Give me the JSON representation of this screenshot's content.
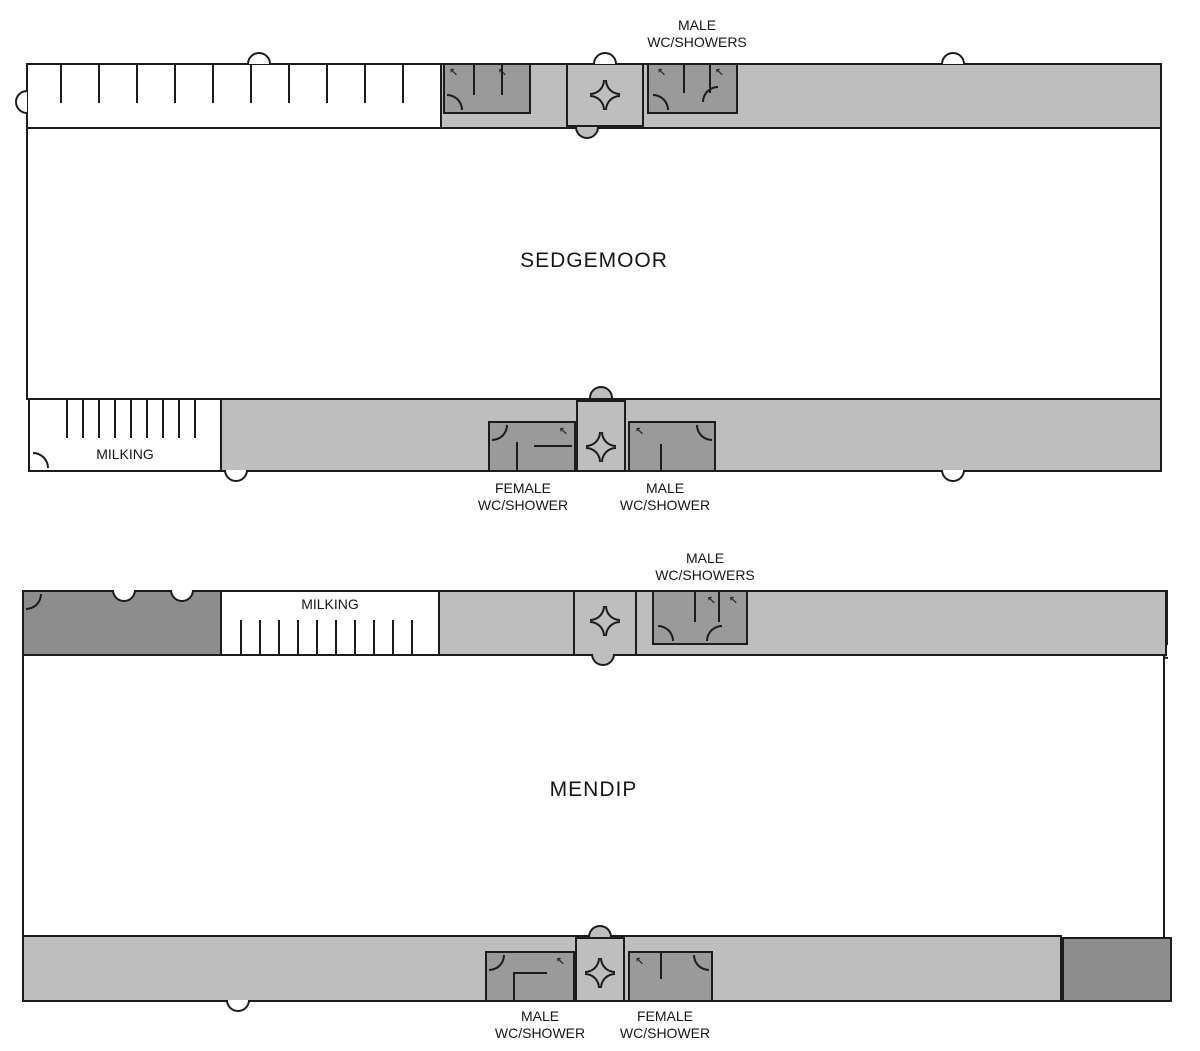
{
  "colors": {
    "light_gray": "#bebebe",
    "wc_gray": "#9a9a9a",
    "block_gray": "#8d8d8d",
    "wall": "#1c1c1c",
    "floor_white": "#ffffff"
  },
  "sedgemoor": {
    "name": "SEDGEMOOR",
    "milking_label": "MILKING",
    "top_outside_label": "MALE\nWC/SHOWERS",
    "bottom_outside_labels": {
      "female": "FEMALE\nWC/SHOWER",
      "male": "MALE\nWC/SHOWER"
    },
    "beds_top": [
      "BED\n45",
      "BED\n46",
      "BED\n47",
      "BED\n48",
      "BED\n49"
    ],
    "rooms_top_right": [
      "50",
      "51",
      "52",
      "53",
      "54"
    ],
    "rooms_bottom_left": [
      "BED\n44",
      "BED\n43",
      "BED\n42",
      "BED\n41",
      "ELEC"
    ],
    "beds_bottom_mid": [
      "BED\n40",
      "BED\n39",
      "BED\n38",
      "BED\n37",
      "BED\n36",
      "BED\n35"
    ],
    "beds_bottom_right": [
      "BED\n34",
      "BED\n33",
      "BED\n32",
      "BED\n31",
      "BED\n30"
    ]
  },
  "mendip": {
    "name": "MENDIP",
    "milking_label": "MILKING",
    "top_outside_label": "MALE\nWC/SHOWERS",
    "bottom_outside_labels": {
      "male": "MALE\nWC/SHOWER",
      "female": "FEMALE\nWC/SHOWER"
    },
    "beds_top": [
      "BED\n19",
      "BED\n20",
      "BED\n21",
      "BED\n22",
      "BED\n23",
      "BED\n24",
      "BED\n25",
      "BED\n26",
      "BED\n27",
      "BED\n28",
      "BED\n29"
    ],
    "beds_bottom_left": [
      "BED\n18",
      "BED\n17",
      "BED\n16",
      "BED\n15",
      "BED\n14"
    ],
    "beds_bottom_mid": [
      "BED\n13",
      "BED\n12",
      "BED\n11",
      "BED\n10",
      "BED\n9",
      "ELEC"
    ],
    "beds_bottom_right": [
      "BED\n8",
      "BED\n7",
      "BED\n6",
      "BED\n5",
      "BED\n4",
      "BED\n3",
      "BED\n2",
      "BED\n1"
    ]
  }
}
